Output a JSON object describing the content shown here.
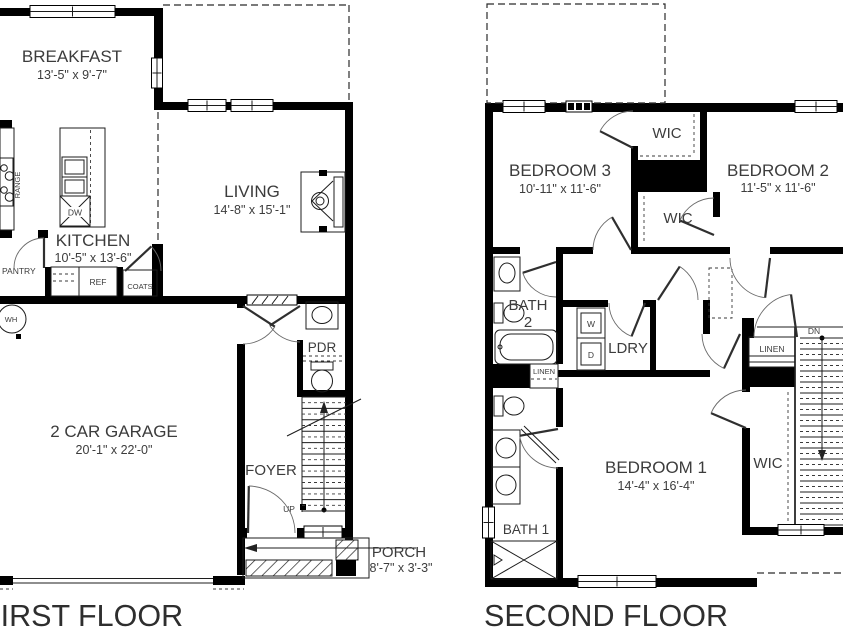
{
  "first_floor": {
    "title": "FIRST FLOOR",
    "rooms": {
      "breakfast": {
        "name": "BREAKFAST",
        "dims": "13'-5\" x 9'-7\""
      },
      "living": {
        "name": "LIVING",
        "dims": "14'-8\" x 15'-1\""
      },
      "kitchen": {
        "name": "KITCHEN",
        "dims": "10'-5\" x 13'-6\""
      },
      "garage": {
        "name": "2 CAR GARAGE",
        "dims": "20'-1\" x 22'-0\""
      },
      "foyer": {
        "name": "FOYER"
      },
      "pdr": {
        "name": "PDR"
      },
      "pantry": {
        "name": "PANTRY"
      },
      "porch": {
        "name": "PORCH",
        "dims": "8'-7\" x 3'-3\""
      }
    },
    "fixtures": {
      "range": "RANGE",
      "dw": "DW",
      "ref": "REF",
      "coats": "COATS",
      "wh": "WH",
      "up": "UP"
    }
  },
  "second_floor": {
    "title": "SECOND FLOOR",
    "rooms": {
      "bedroom3": {
        "name": "BEDROOM 3",
        "dims": "10'-11\" x 11'-6\""
      },
      "bedroom2": {
        "name": "BEDROOM 2",
        "dims": "11'-5\" x 11'-6\""
      },
      "bedroom1": {
        "name": "BEDROOM 1",
        "dims": "14'-4\" x 16'-4\""
      },
      "wic_top": "WIC",
      "wic_mid": "WIC",
      "wic_b1": "WIC",
      "bath2_line1": "BATH",
      "bath2_line2": "2",
      "bath1": "BATH 1",
      "ldry": "LDRY",
      "linen_bath": "LINEN",
      "linen_hall": "LINEN"
    },
    "fixtures": {
      "washer": "W",
      "dryer": "D",
      "dn": "DN"
    }
  }
}
